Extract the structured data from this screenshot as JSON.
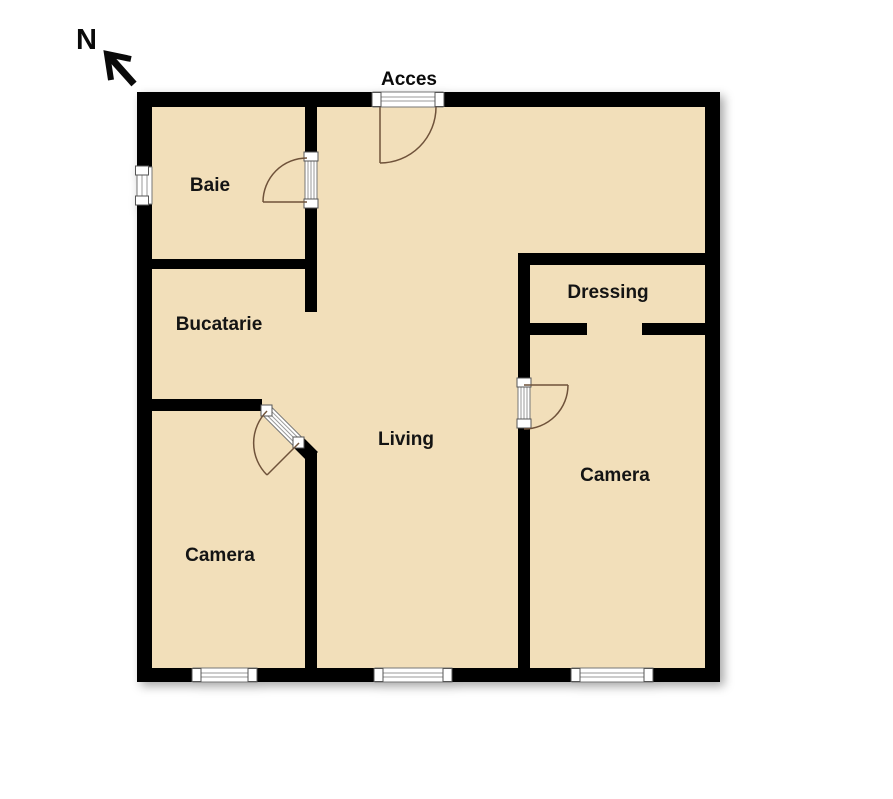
{
  "plan": {
    "north_label": "N",
    "entrance_label": "Acces",
    "rooms": [
      {
        "id": "baie",
        "label": "Baie"
      },
      {
        "id": "bucatarie",
        "label": "Bucatarie"
      },
      {
        "id": "camera-1",
        "label": "Camera"
      },
      {
        "id": "living",
        "label": "Living"
      },
      {
        "id": "dressing",
        "label": "Dressing"
      },
      {
        "id": "camera-2",
        "label": "Camera"
      }
    ],
    "features": {
      "windows": 4,
      "doors": 4,
      "entrance_side": "top"
    },
    "colors": {
      "floor": "#f2dfba",
      "wall": "#000000",
      "door_swing": "#6f523a",
      "window_frame": "#777777",
      "background": "#ffffff"
    }
  }
}
